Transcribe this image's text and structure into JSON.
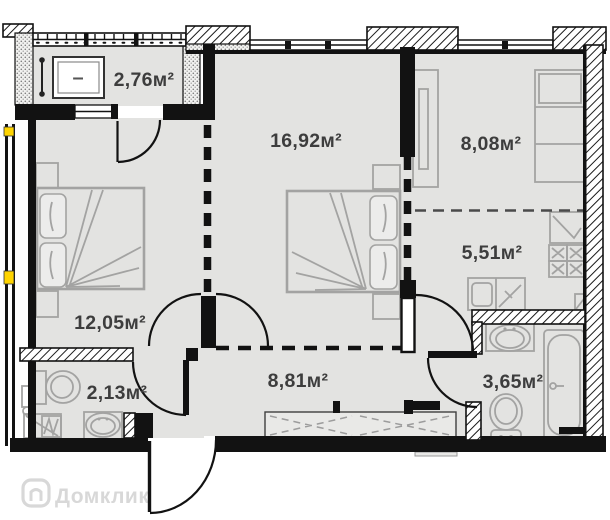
{
  "floorplan": {
    "watermark": "Домклик",
    "balcony_unit_label": "–",
    "rooms": [
      {
        "key": "balcony",
        "label": "2,76м²"
      },
      {
        "key": "living-room",
        "label": "16,92м²"
      },
      {
        "key": "room-8",
        "label": "8,08м²"
      },
      {
        "key": "kitchen",
        "label": "5,51м²"
      },
      {
        "key": "bedroom",
        "label": "12,05м²"
      },
      {
        "key": "wc",
        "label": "2,13м²"
      },
      {
        "key": "hallway",
        "label": "8,81м²"
      },
      {
        "key": "bathroom",
        "label": "3,65м²"
      }
    ],
    "colors": {
      "wall": "#121212",
      "floor": "#e3e3e1",
      "furn": "#a3a3a2",
      "label": "#3d3d3d",
      "yellow": "#ffd400",
      "watermark": "#cccccc"
    }
  }
}
